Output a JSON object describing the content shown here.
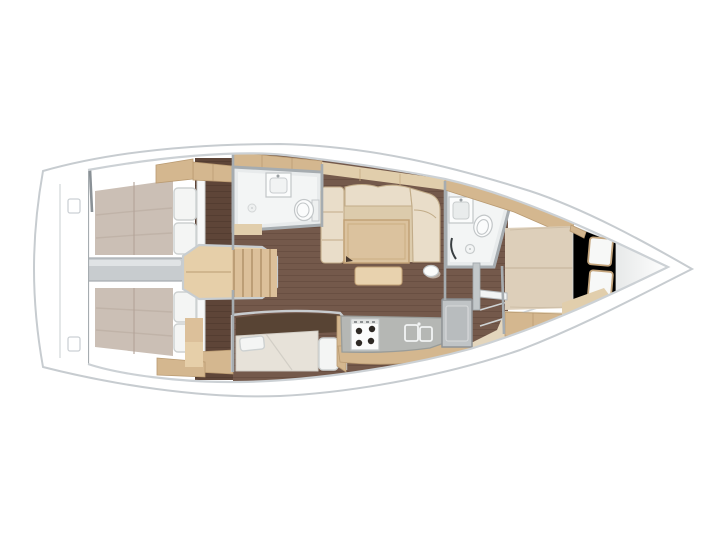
{
  "meta": {
    "title": "Sailing yacht interior layout — top-down floor plan",
    "description": "Top view floor plan of a sailing yacht interior: two aft double cabins with an engine compartment between them, companionway stairs, aft head with toilet and sink, saloon with L-shaped sofa, folding table and stool, quarter berth settee, linear galley with stove and double sink, forward head with shower, and a forward owner cabin with island double bed leading to the bow."
  },
  "colors": {
    "hull_line": "#c7ccd0",
    "deck_line": "#ccd1d5",
    "floor": "#74594b",
    "floor_line": "#5e463a",
    "floor_dark": "#5e4538",
    "recess": "#584434",
    "mattress": "#cbbfb5",
    "mattress_line": "#b4a498",
    "pillow": "#f4f5f4",
    "pillow_line": "#cdd1d1",
    "headboard": "#f7f8f8",
    "cream": "#e9ddc9",
    "cream_shade": "#dccbac",
    "cream_line": "#c2ac89",
    "wood": "#dbc29e",
    "wood_line": "#c2a176",
    "wood_light": "#e8d2ae",
    "tan": "#d4b78f",
    "tan_line": "#b99a71",
    "tan_light": "#e1ceac",
    "beige": "#e4d6bd",
    "counter": "#b5b7b4",
    "counter_line": "#999c99",
    "steel": "#9ba2a7",
    "wall": "#a6acb0",
    "bath": "#e8ebec",
    "bath_floor": "#f3f5f5",
    "fixture": "#fbfcfc",
    "fixture_line": "#c2c6c8",
    "engine": "#c8cccf",
    "engine_hi": "#e0e3e5",
    "stairs": "#dcc09a",
    "stairs_dark": "#a8885e",
    "stairs_light": "#e6cfa9",
    "berth_cushion": "#e7e2d9",
    "fwd_mattress": "#ddcfba",
    "fwd_head_zone": "#eceded",
    "bow_shade": "#e7e9e9"
  }
}
